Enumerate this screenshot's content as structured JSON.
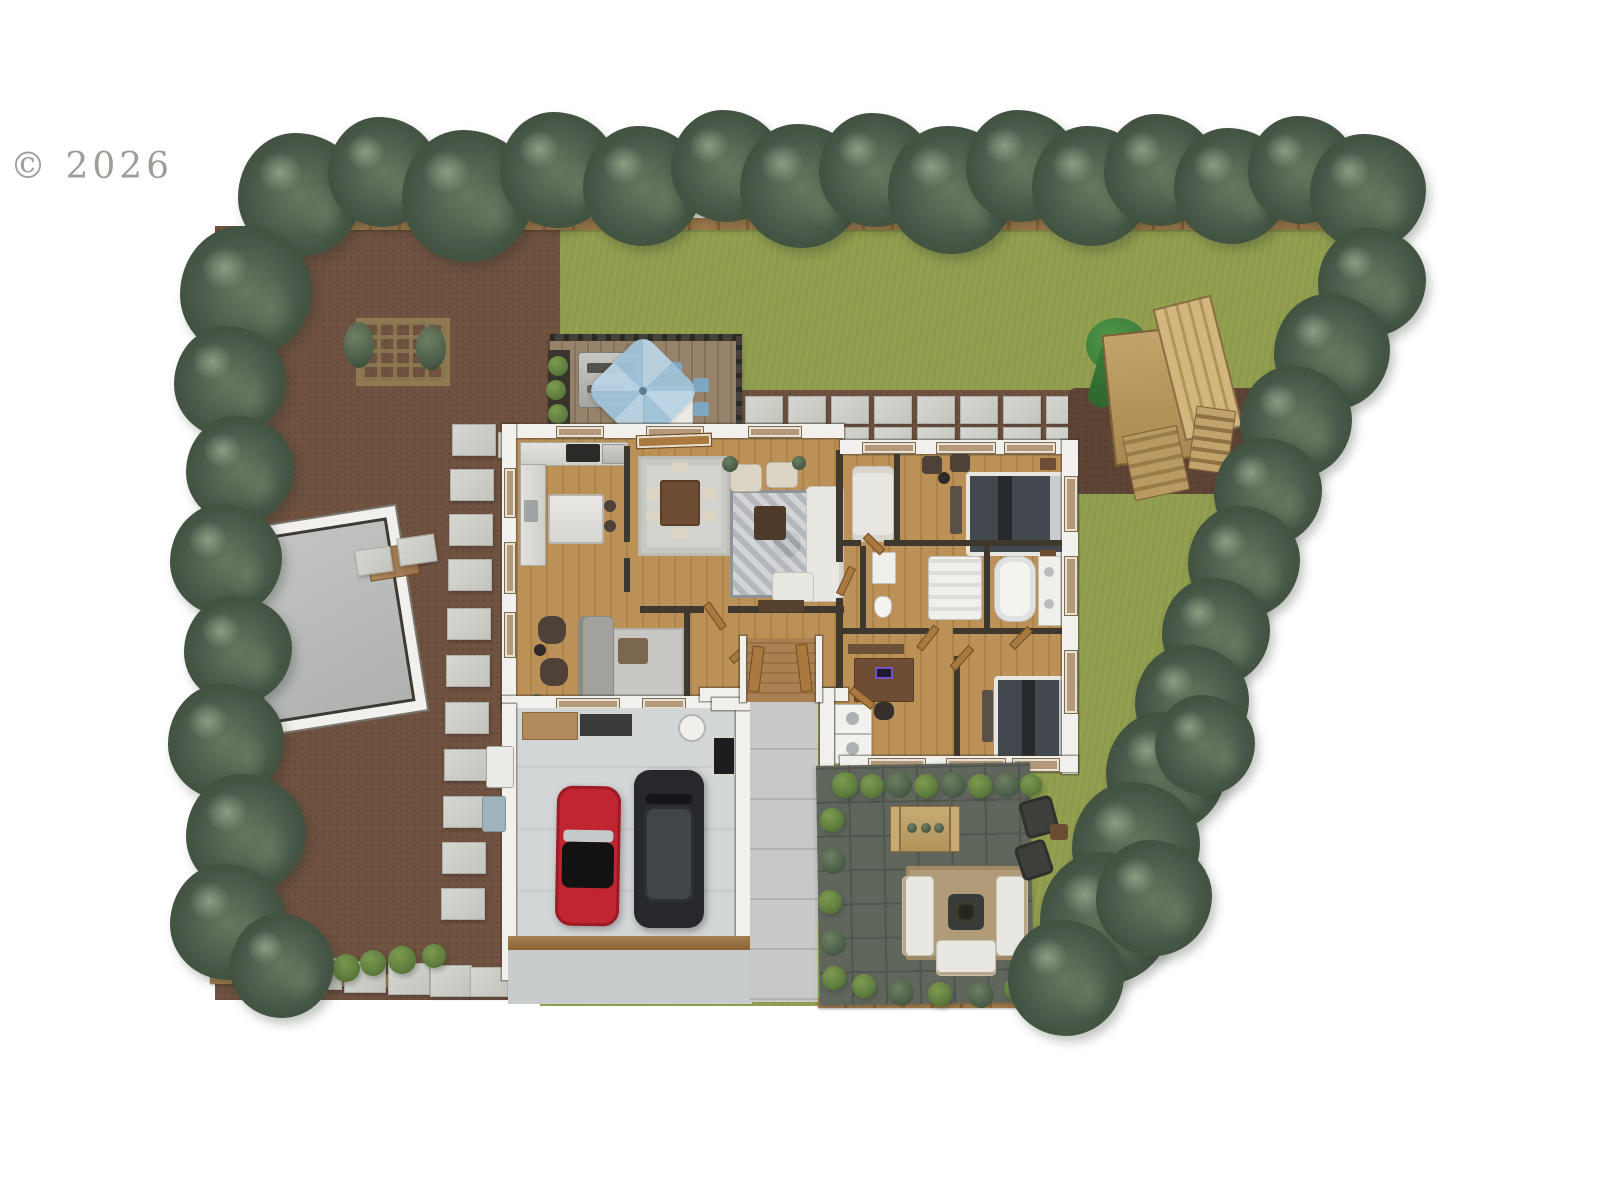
{
  "watermark": {
    "text": "© 2026"
  },
  "palette": {
    "page_bg": "#ffffff",
    "watermark": "#8d8d88",
    "lawn": "#93a050",
    "mulch": "#6f5240",
    "mulch_dark": "#5e4434",
    "fence": "#a37c4c",
    "fence_dark": "#8c6336",
    "stone": "#cdcfc8",
    "deck_wood": "#97836c",
    "deck_wood_dark": "#867257",
    "rail_dark": "#2c2a26",
    "wood_floor": "#bb9157",
    "wood_floor_dark": "#ac8348",
    "wall_white": "#f1f0ec",
    "wall_dark": "#3e382e",
    "marble": "#dddcd7",
    "rug_light": "#d2d2ce",
    "rug_pattern": "#b4b7bb",
    "sofa_white": "#e9e7e2",
    "sofa_gray": "#a3a19c",
    "chair_dark": "#4e4238",
    "chair_cream": "#dcd5c5",
    "table_brown": "#6f4c34",
    "coffee_dark": "#4f3b2a",
    "bed_dark": "#43484e",
    "bed_frame": "#e8e6e1",
    "pillow": "#c9cbcd",
    "garage_floor": "#d3d6d7",
    "driveway": "#c8cccd",
    "concrete": "#c6c9c8",
    "paver": "#61665d",
    "paver_line": "#51564e",
    "patio_rug": "#b29b78",
    "fire_pit": "#383b37",
    "car_red": "#c02531",
    "car_black": "#26282b",
    "suv_roof": "#41454a",
    "umbrella": "#9fc2d8",
    "umbrella2": "#bad4e4",
    "chair_blue": "#7fa6c0",
    "grill": "#bfbdb8",
    "tree_a": "#8d9c84",
    "tree_b": "#66785f",
    "tree_c": "#49594a",
    "tree_d": "#36452f",
    "bush": "#5f7d3e",
    "bush_light": "#7d9b4f",
    "slide_green": "#3c7d3a",
    "play_wood": "#b99a63",
    "window_tan": "#b3997a",
    "door_tan": "#a9793f"
  }
}
